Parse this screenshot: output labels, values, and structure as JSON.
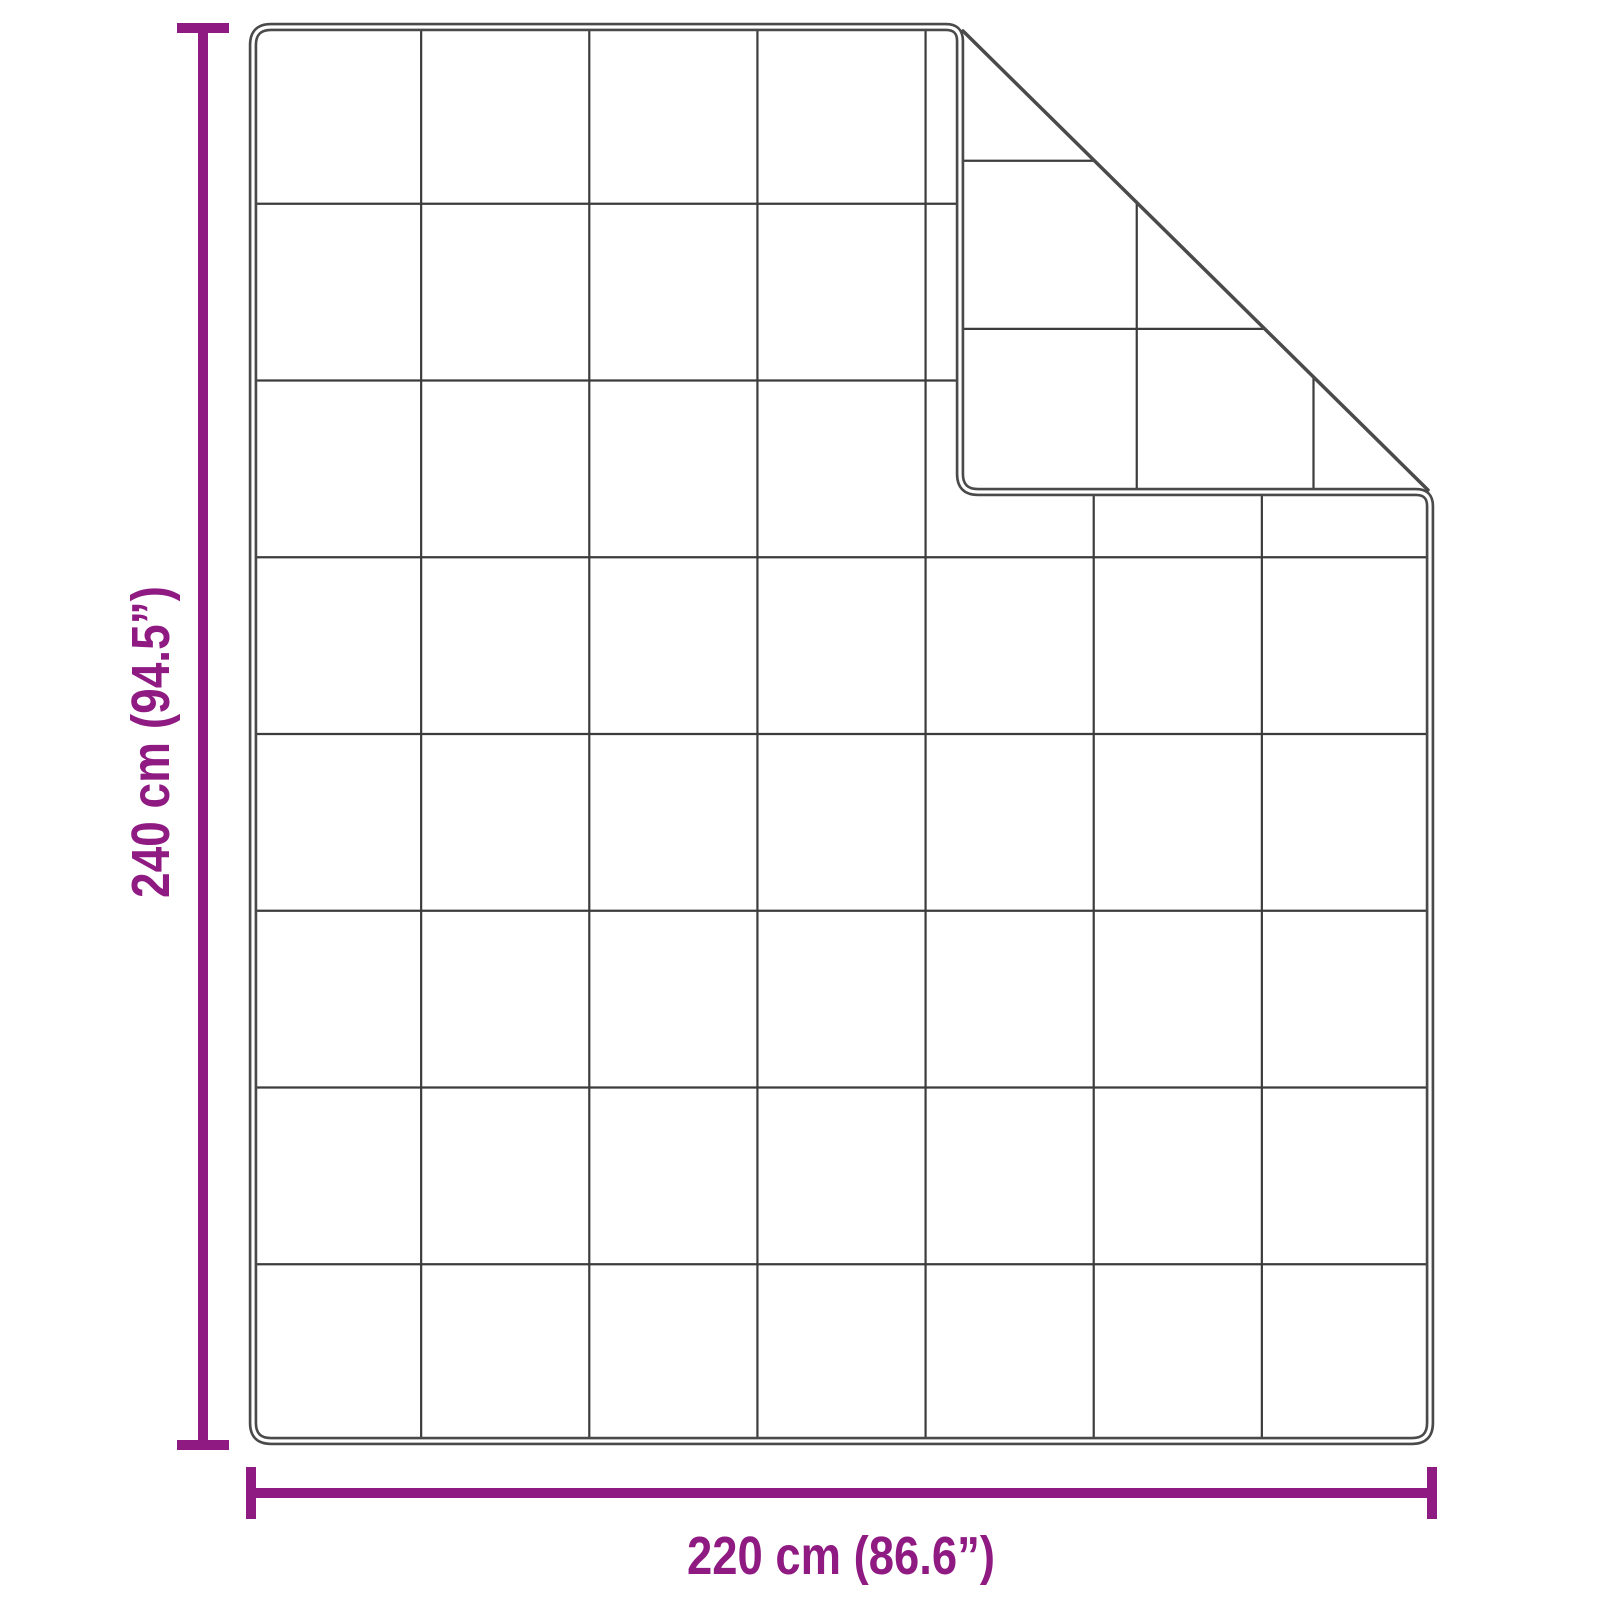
{
  "diagram": {
    "type": "product-dimension-diagram",
    "object": "quilted weighted blanket, top-right corner folded over showing reverse side",
    "grid": {
      "columns": 7,
      "rows": 8
    },
    "fold": {
      "position": "top-right",
      "shows": "reverse-side quilt grid"
    }
  },
  "dimensions": {
    "height": {
      "value_cm": 240,
      "value_inch": 94.5,
      "label": "240 cm (94.5”)"
    },
    "width": {
      "value_cm": 220,
      "value_inch": 86.6,
      "label": "220 cm (86.6”)"
    }
  },
  "colors": {
    "accent": "#8E1A82",
    "outline": "#4a4a4a",
    "grid": "#3c3c3c",
    "background": "#ffffff"
  }
}
